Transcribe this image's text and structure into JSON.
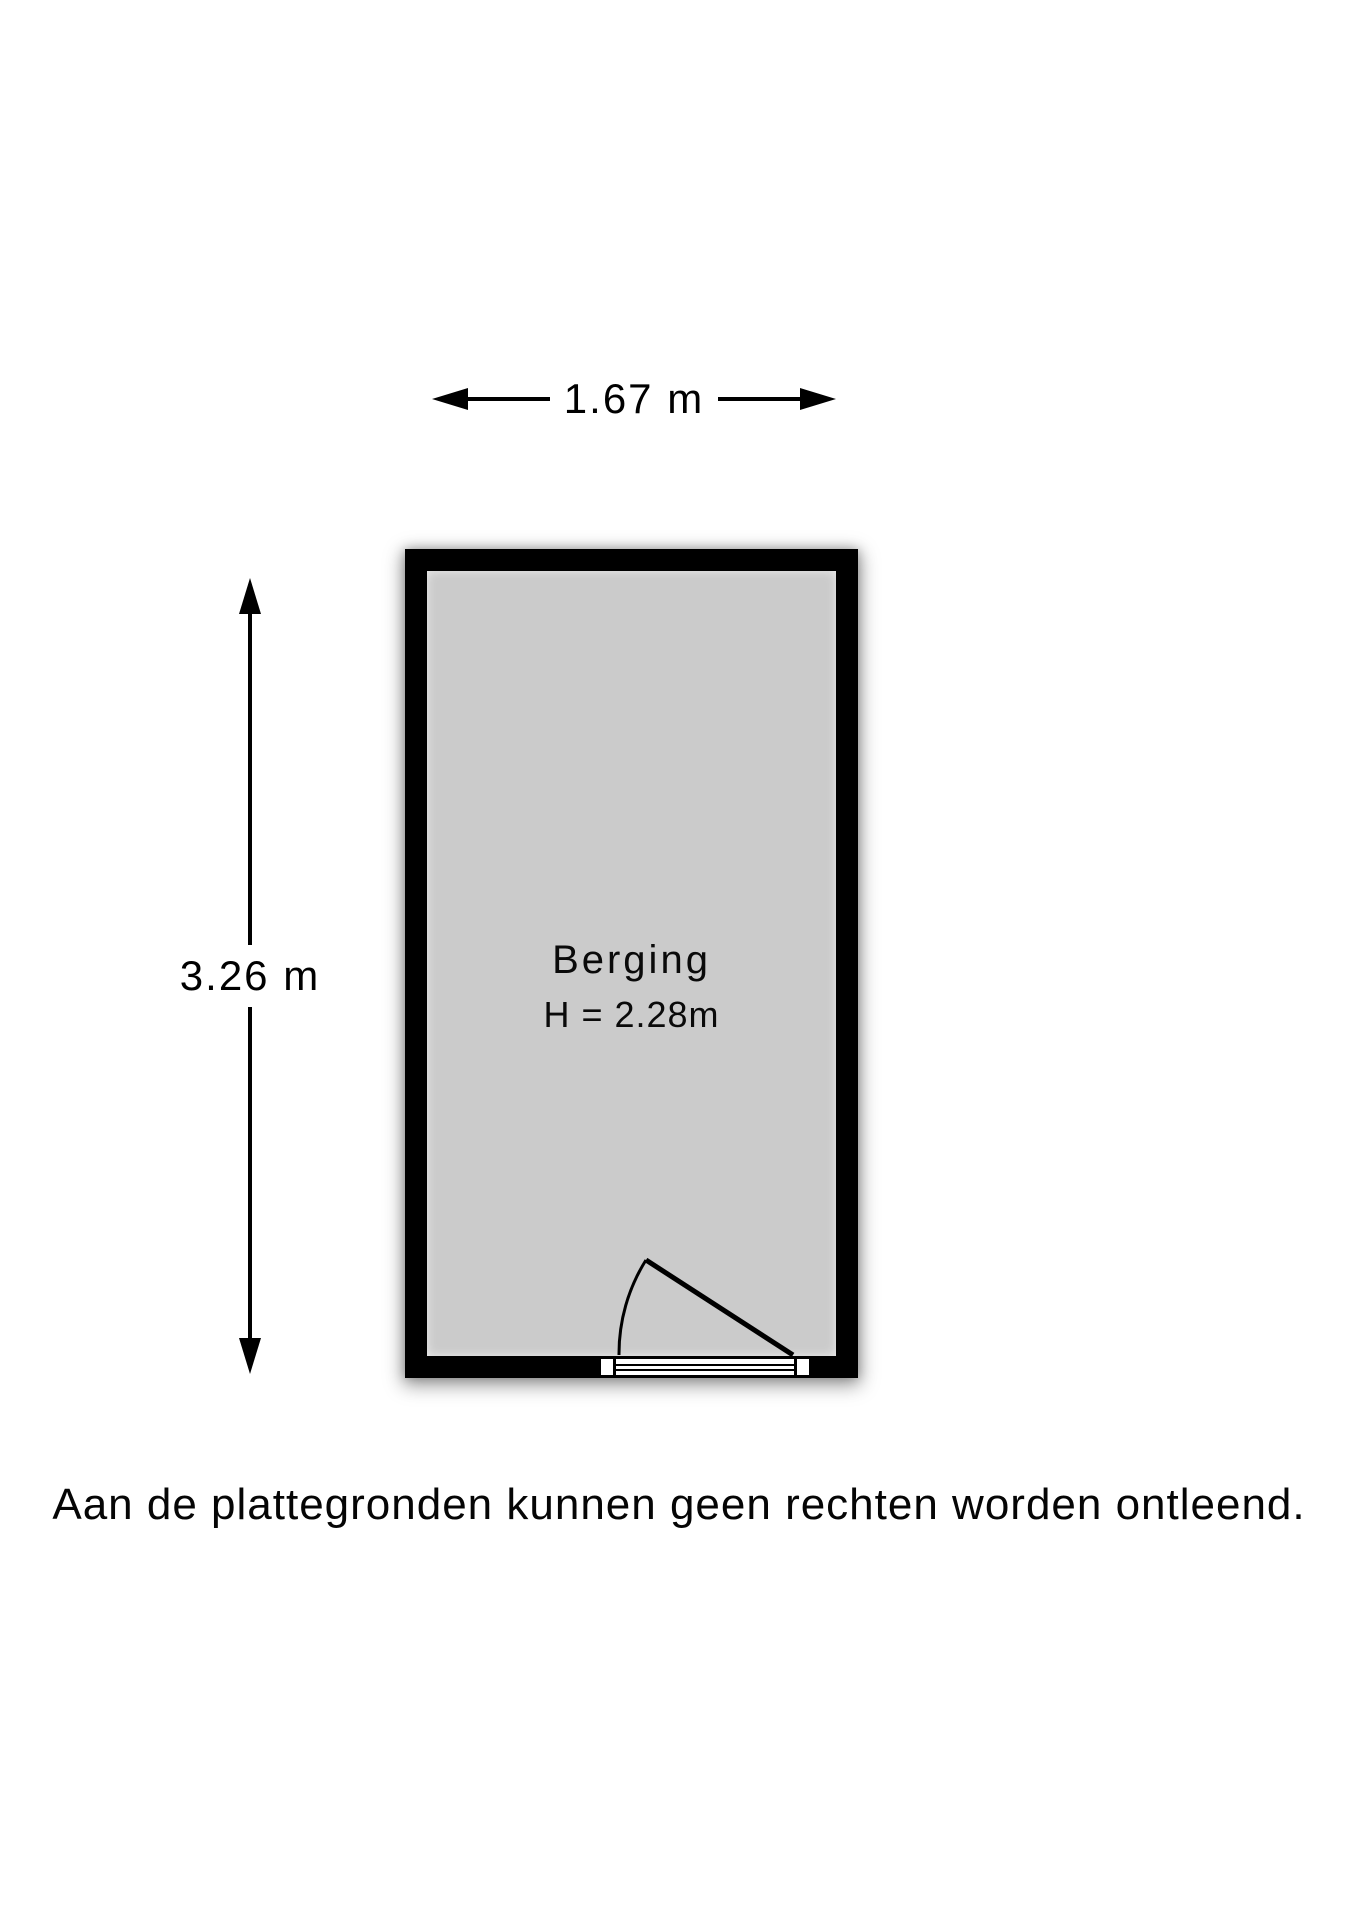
{
  "colors": {
    "wall": "#000000",
    "floor": "#cbcbcb",
    "line": "#000000",
    "background": "#ffffff"
  },
  "floorplan": {
    "room": {
      "name": "Berging",
      "ceiling_height": "H = 2.28m"
    },
    "dimensions": {
      "width": "1.67 m",
      "depth": "3.26 m"
    }
  },
  "disclaimer": "Aan de plattegronden kunnen geen rechten worden ontleend."
}
